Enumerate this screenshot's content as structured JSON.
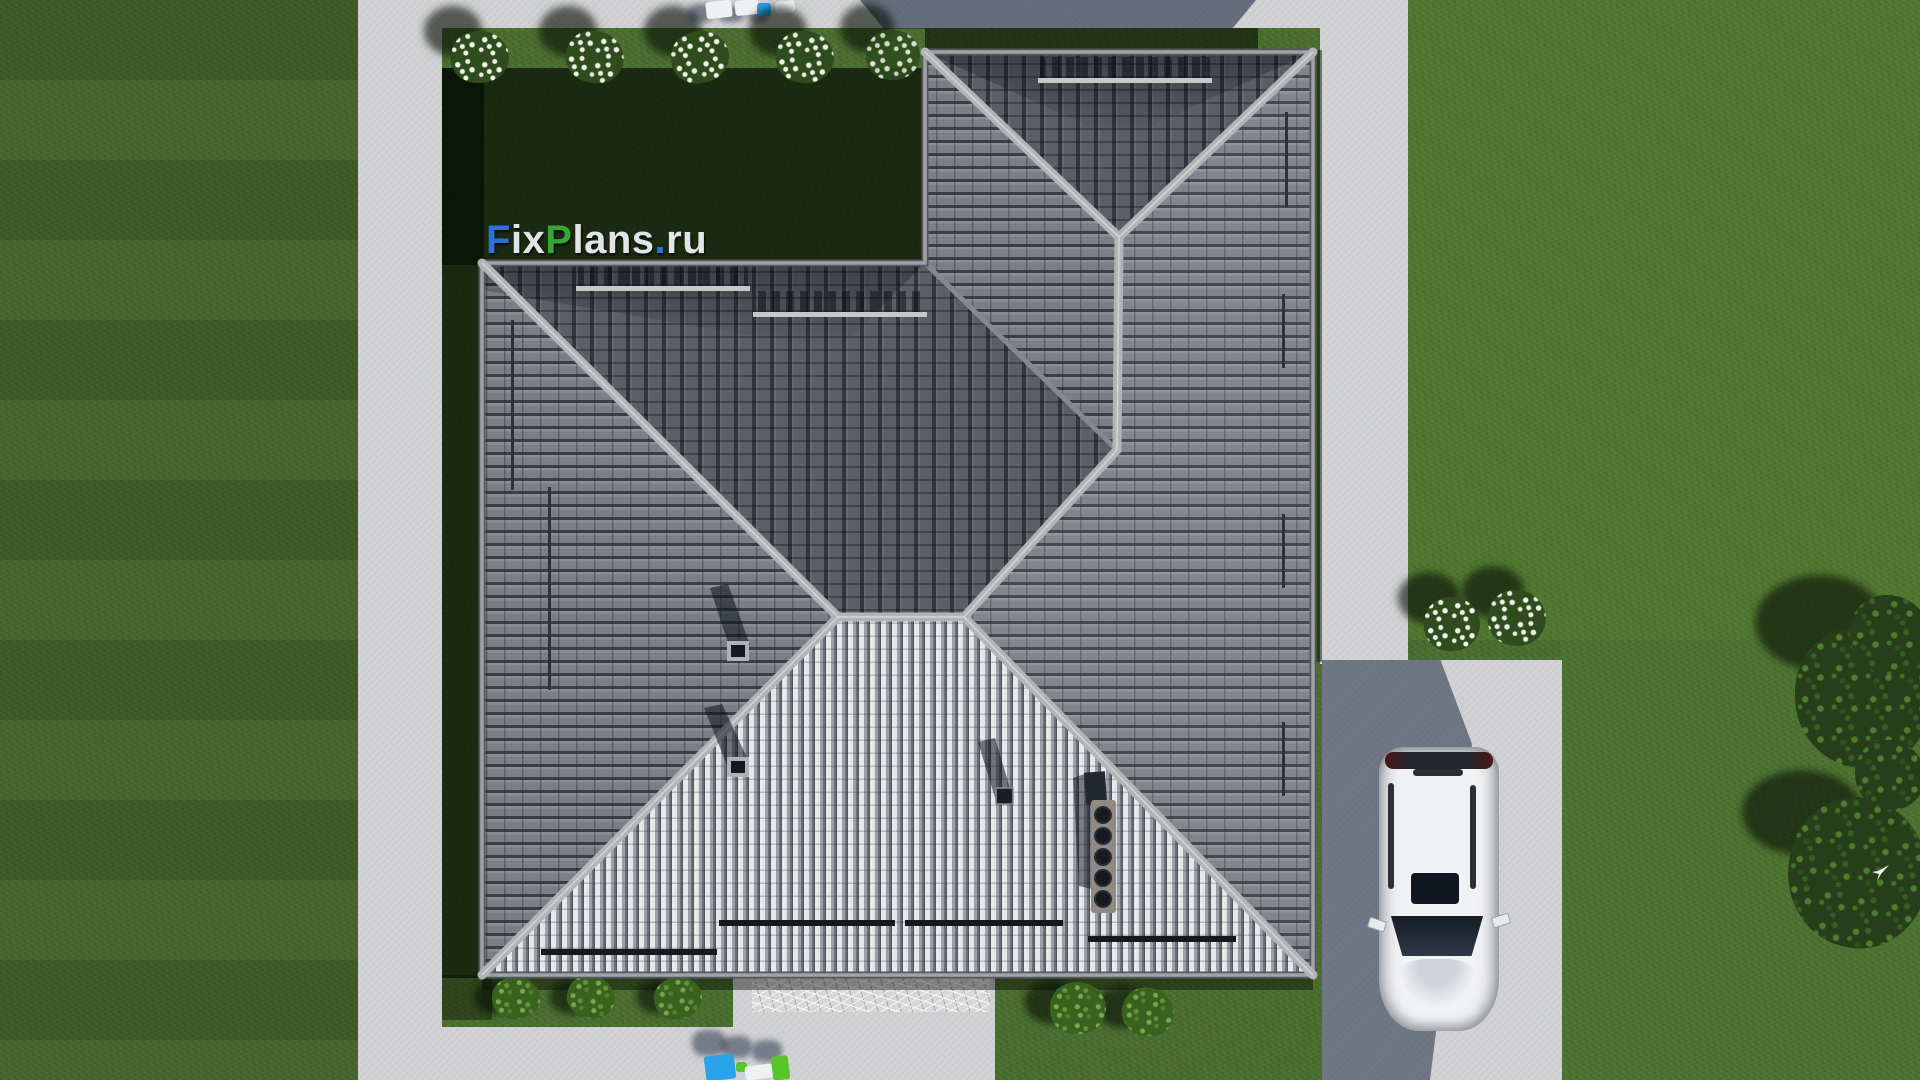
{
  "watermark": {
    "text": "FixPlans.ru",
    "segments": [
      {
        "text": "F",
        "color": "#2f6fd9"
      },
      {
        "text": "ix",
        "color": "#e2e4e8"
      },
      {
        "text": "P",
        "color": "#36a637"
      },
      {
        "text": "lans",
        "color": "#e2e4e8"
      },
      {
        "text": ".",
        "color": "#2f6fd9"
      },
      {
        "text": "ru",
        "color": "#e2e4e8"
      }
    ]
  },
  "scene": {
    "description": "Aerial top-down 3D render of a house plan: hipped gray tile roof with chimneys, vent pipes and snow rails, concrete walkways, driveway with white SUV, lawn with flowering bushes, shrubs, trees and a flying bird.",
    "objects": [
      "lawn",
      "concrete walkways",
      "hipped tile roof",
      "roof chimneys",
      "roof vent pipes",
      "snow guard rails",
      "white SUV",
      "driveway",
      "flowering white bushes",
      "green shrubs",
      "trees",
      "sun loungers",
      "stone terrace mat",
      "flying bird"
    ],
    "colors": {
      "grass": "#4c7030",
      "grass_left": "#47642c",
      "grass_right": "#52812f",
      "concrete": "#d0d1d3",
      "roof_west": "#7b7e85",
      "roof_north": "#5a5e66",
      "roof_bright": "#e7e8ea",
      "roof_gap": "#3b3e44",
      "ridge": "#b2b4b6",
      "car_body": "#f1f2f4",
      "car_glass": "#1b232e",
      "lounger_blue": "#2aa3ea",
      "lounger_green": "#58c42c",
      "flowers": "#f2f4ea",
      "bush": "#2e4c1d",
      "tree": "#263f1a",
      "shadow_slate": "#1e2a42"
    }
  }
}
